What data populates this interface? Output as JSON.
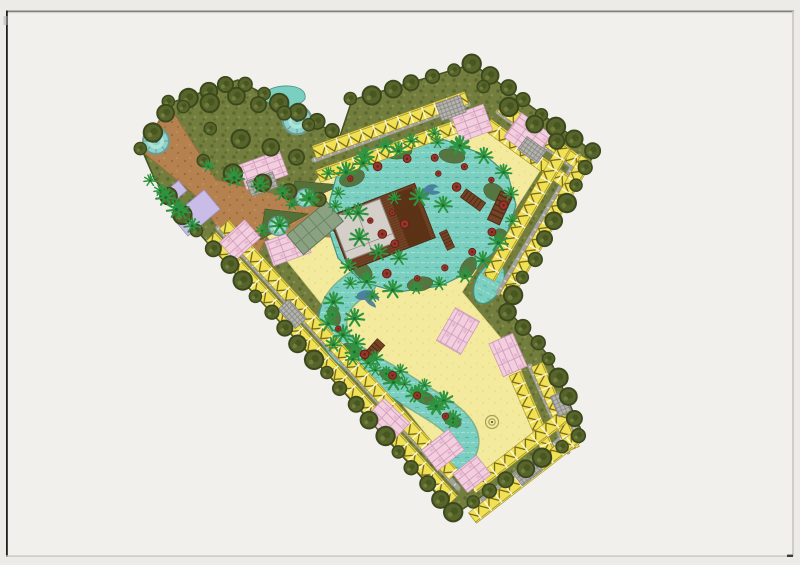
{
  "window": {
    "kind": "scanned-page-with-site-plan-image"
  },
  "plan": {
    "name": "resort-master-plan",
    "features": [
      "green-belt",
      "perimeter-residential-rows",
      "pink-residential-clusters",
      "central-lagoon-pool",
      "lazy-river",
      "sun-deck",
      "clubhouse",
      "green-roof-pavilion",
      "entry-road",
      "fountain-plazas",
      "lavender-courts",
      "palm-planting",
      "pool-umbrellas",
      "dolphin-motifs",
      "wooden-bridges"
    ],
    "palette": {
      "bg": "#edebe7",
      "page": "#f2f0ec",
      "borderDark": "#1e1e1e",
      "borderTop": "#7d7d7a",
      "borderLight": "#c9c6c1",
      "cornerDash": "#3a3a38",
      "olive": "#727d3e",
      "oliveD1": "#5a6a2e",
      "oliveD2": "#81904a",
      "siteEdge": "#46511f",
      "tree": "#57652c",
      "treeEdge": "#3a481c",
      "treeCore": "#48571f",
      "treeHi": "#6e7d3a",
      "palm": "#2e9440",
      "palmDark": "#1d6f2e",
      "sand": "#f4ea9d",
      "sandDot": "#e6da7e",
      "water": "#7bcfc0",
      "waterLight": "#abe4d8",
      "waterDark": "#55b2a0",
      "waterEdge": "#3f9483",
      "roadBrown": "#b5824f",
      "roadBrownDark": "#9c6b3c",
      "roadBrownLight": "#c49663",
      "roadGray": "#a3a19c",
      "roadGrayLight": "#d2d0cb",
      "roofYellow": "#f1e154",
      "roofLine": "#6f5f16",
      "roofRidge": "#9a8c2a",
      "unitGap": "#fdfbe8",
      "pink": "#f3cede",
      "pinkLine": "#c795b5",
      "pinkCell": "#e8b7cf",
      "grayBlock": "#b5b3ae",
      "grayBlockLine": "#84827d",
      "deck": "#754427",
      "deckLine": "#5f3318",
      "deckEdge": "#4f2d15",
      "pergola": "#5a3115",
      "clubGray": "#d5cfc9",
      "clubGrayEdge": "#8d8781",
      "greenRoof": "#8aa182",
      "greenRoofLine": "#5c7a58",
      "lavender": "#c9bce9",
      "lavenderEdge": "#9f92c5",
      "umbrella": "#96352a",
      "umbrellaDark": "#621d14",
      "fountainRim": "#6f9a94",
      "fountainWater": "#8fd2cb",
      "fountainCore": "#1f4a55",
      "dolphin": "#46789c",
      "spiral": "#a89f55",
      "wedgeGreen": "#55713a"
    }
  }
}
